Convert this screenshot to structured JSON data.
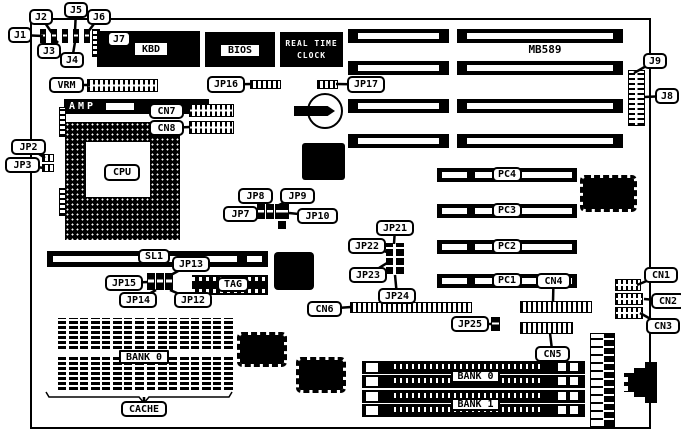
{
  "board": {
    "model": "MB589",
    "colors": {
      "line": "#000000",
      "background": "#ffffff"
    }
  },
  "chips": {
    "kbd": "KBD",
    "bios": "BIOS",
    "rtc_line1": "REAL TIME",
    "rtc_line2": "CLOCK",
    "amp": "AMP"
  },
  "callouts": [
    {
      "id": "j1",
      "label": "J1",
      "x": 8,
      "y": 27,
      "w": 24,
      "h": 16,
      "tx": 43,
      "ty": 36
    },
    {
      "id": "j2",
      "label": "J2",
      "x": 29,
      "y": 9,
      "w": 24,
      "h": 16,
      "tx": 52,
      "ty": 33
    },
    {
      "id": "j5",
      "label": "J5",
      "x": 64,
      "y": 2,
      "w": 24,
      "h": 16,
      "tx": 75,
      "ty": 31
    },
    {
      "id": "j6",
      "label": "J6",
      "x": 87,
      "y": 9,
      "w": 24,
      "h": 16,
      "tx": 88,
      "ty": 32
    },
    {
      "id": "j3",
      "label": "J3",
      "x": 37,
      "y": 43,
      "w": 24,
      "h": 16,
      "tx": 58,
      "ty": 41
    },
    {
      "id": "j4",
      "label": "J4",
      "x": 60,
      "y": 52,
      "w": 24,
      "h": 16,
      "tx": 75,
      "ty": 42
    },
    {
      "id": "j7",
      "label": "J7",
      "x": 107,
      "y": 31,
      "w": 24,
      "h": 16,
      "tx": 98,
      "ty": 39
    },
    {
      "id": "vrm",
      "label": "VRM",
      "x": 49,
      "y": 77,
      "w": 35,
      "h": 16,
      "tx": 90,
      "ty": 85
    },
    {
      "id": "jp16",
      "label": "JP16",
      "x": 207,
      "y": 76,
      "w": 38,
      "h": 17,
      "tx": 252,
      "ty": 84
    },
    {
      "id": "jp17",
      "label": "JP17",
      "x": 347,
      "y": 76,
      "w": 38,
      "h": 17,
      "tx": 336,
      "ty": 84
    },
    {
      "id": "j9",
      "label": "J9",
      "x": 643,
      "y": 53,
      "w": 24,
      "h": 16,
      "tx": 634,
      "ty": 73
    },
    {
      "id": "j8",
      "label": "J8",
      "x": 655,
      "y": 88,
      "w": 24,
      "h": 16,
      "tx": 644,
      "ty": 97
    },
    {
      "id": "cn7",
      "label": "CN7",
      "x": 149,
      "y": 103,
      "w": 35,
      "h": 16,
      "tx": 190,
      "ty": 110
    },
    {
      "id": "cn8",
      "label": "CN8",
      "x": 149,
      "y": 120,
      "w": 35,
      "h": 16,
      "tx": 190,
      "ty": 127
    },
    {
      "id": "jp2",
      "label": "JP2",
      "x": 11,
      "y": 139,
      "w": 35,
      "h": 16,
      "tx": 45,
      "ty": 158
    },
    {
      "id": "jp3",
      "label": "JP3",
      "x": 5,
      "y": 157,
      "w": 35,
      "h": 16,
      "tx": 44,
      "ty": 168
    },
    {
      "id": "jp8",
      "label": "JP8",
      "x": 238,
      "y": 188,
      "w": 35,
      "h": 16,
      "tx": 263,
      "ty": 206
    },
    {
      "id": "jp9",
      "label": "JP9",
      "x": 280,
      "y": 188,
      "w": 35,
      "h": 16,
      "tx": 277,
      "ty": 206
    },
    {
      "id": "jp7",
      "label": "JP7",
      "x": 223,
      "y": 206,
      "w": 35,
      "h": 16,
      "tx": 258,
      "ty": 212
    },
    {
      "id": "jp10",
      "label": "JP10",
      "x": 297,
      "y": 208,
      "w": 41,
      "h": 16,
      "tx": 289,
      "ty": 213
    },
    {
      "id": "sl1",
      "label": "SL1",
      "x": 138,
      "y": 249,
      "w": 32,
      "h": 15
    },
    {
      "id": "jp13",
      "label": "JP13",
      "x": 172,
      "y": 256,
      "w": 38,
      "h": 16,
      "tx": 169,
      "ty": 276
    },
    {
      "id": "jp15",
      "label": "JP15",
      "x": 105,
      "y": 275,
      "w": 38,
      "h": 16,
      "tx": 148,
      "ty": 282
    },
    {
      "id": "jp14",
      "label": "JP14",
      "x": 119,
      "y": 292,
      "w": 38,
      "h": 16,
      "tx": 156,
      "ty": 290
    },
    {
      "id": "jp12",
      "label": "JP12",
      "x": 174,
      "y": 292,
      "w": 38,
      "h": 16,
      "tx": 170,
      "ty": 290
    },
    {
      "id": "tag",
      "label": "TAG",
      "x": 217,
      "y": 277,
      "w": 32,
      "h": 15
    },
    {
      "id": "jp21",
      "label": "JP21",
      "x": 376,
      "y": 220,
      "w": 38,
      "h": 16,
      "tx": 394,
      "ty": 244
    },
    {
      "id": "jp22",
      "label": "JP22",
      "x": 348,
      "y": 238,
      "w": 38,
      "h": 16,
      "tx": 387,
      "ty": 252
    },
    {
      "id": "jp23",
      "label": "JP23",
      "x": 349,
      "y": 267,
      "w": 38,
      "h": 16,
      "tx": 387,
      "ty": 263
    },
    {
      "id": "jp24",
      "label": "JP24",
      "x": 378,
      "y": 288,
      "w": 38,
      "h": 16,
      "tx": 395,
      "ty": 275
    },
    {
      "id": "cn6",
      "label": "CN6",
      "x": 307,
      "y": 301,
      "w": 35,
      "h": 16,
      "tx": 351,
      "ty": 307
    },
    {
      "id": "jp25",
      "label": "JP25",
      "x": 451,
      "y": 316,
      "w": 38,
      "h": 16,
      "tx": 492,
      "ty": 324
    },
    {
      "id": "cn4",
      "label": "CN4",
      "x": 536,
      "y": 273,
      "w": 35,
      "h": 16,
      "tx": 553,
      "ty": 302
    },
    {
      "id": "cn5",
      "label": "CN5",
      "x": 535,
      "y": 346,
      "w": 35,
      "h": 16,
      "tx": 550,
      "ty": 333
    },
    {
      "id": "cn1",
      "label": "CN1",
      "x": 644,
      "y": 267,
      "w": 34,
      "h": 16,
      "tx": 637,
      "ty": 285
    },
    {
      "id": "cn2",
      "label": "CN2",
      "x": 651,
      "y": 293,
      "w": 34,
      "h": 16,
      "tx": 644,
      "ty": 299
    },
    {
      "id": "cn3",
      "label": "CN3",
      "x": 646,
      "y": 318,
      "w": 34,
      "h": 16,
      "tx": 640,
      "ty": 313
    },
    {
      "id": "pc4",
      "label": "PC4",
      "x": 492,
      "y": 167,
      "w": 30,
      "h": 15
    },
    {
      "id": "pc3",
      "label": "PC3",
      "x": 492,
      "y": 203,
      "w": 30,
      "h": 15
    },
    {
      "id": "pc2",
      "label": "PC2",
      "x": 492,
      "y": 239,
      "w": 30,
      "h": 15
    },
    {
      "id": "pc1",
      "label": "PC1",
      "x": 492,
      "y": 273,
      "w": 30,
      "h": 15
    },
    {
      "id": "cpu",
      "label": "CPU",
      "x": 104,
      "y": 164,
      "w": 36,
      "h": 17
    },
    {
      "id": "kbd",
      "label": "KBD",
      "x": 133,
      "y": 41,
      "w": 36,
      "h": 16,
      "sq": true
    },
    {
      "id": "bios",
      "label": "BIOS",
      "x": 219,
      "y": 43,
      "w": 42,
      "h": 15,
      "sq": true
    },
    {
      "id": "bank0-cache",
      "label": "BANK 0",
      "x": 119,
      "y": 350,
      "w": 50,
      "h": 14,
      "sq": true
    },
    {
      "id": "cache",
      "label": "CACHE",
      "x": 121,
      "y": 401,
      "w": 46,
      "h": 16,
      "tx": 144,
      "ty": 397
    },
    {
      "id": "bank0-simm",
      "label": "BANK 0",
      "x": 451,
      "y": 370,
      "w": 49,
      "h": 13,
      "sq": true
    },
    {
      "id": "bank1-simm",
      "label": "BANK 1",
      "x": 451,
      "y": 398,
      "w": 49,
      "h": 13,
      "sq": true
    },
    {
      "id": "model",
      "label": "MB589",
      "x": 505,
      "y": 42,
      "w": 80,
      "h": 14,
      "style": "plain"
    }
  ]
}
